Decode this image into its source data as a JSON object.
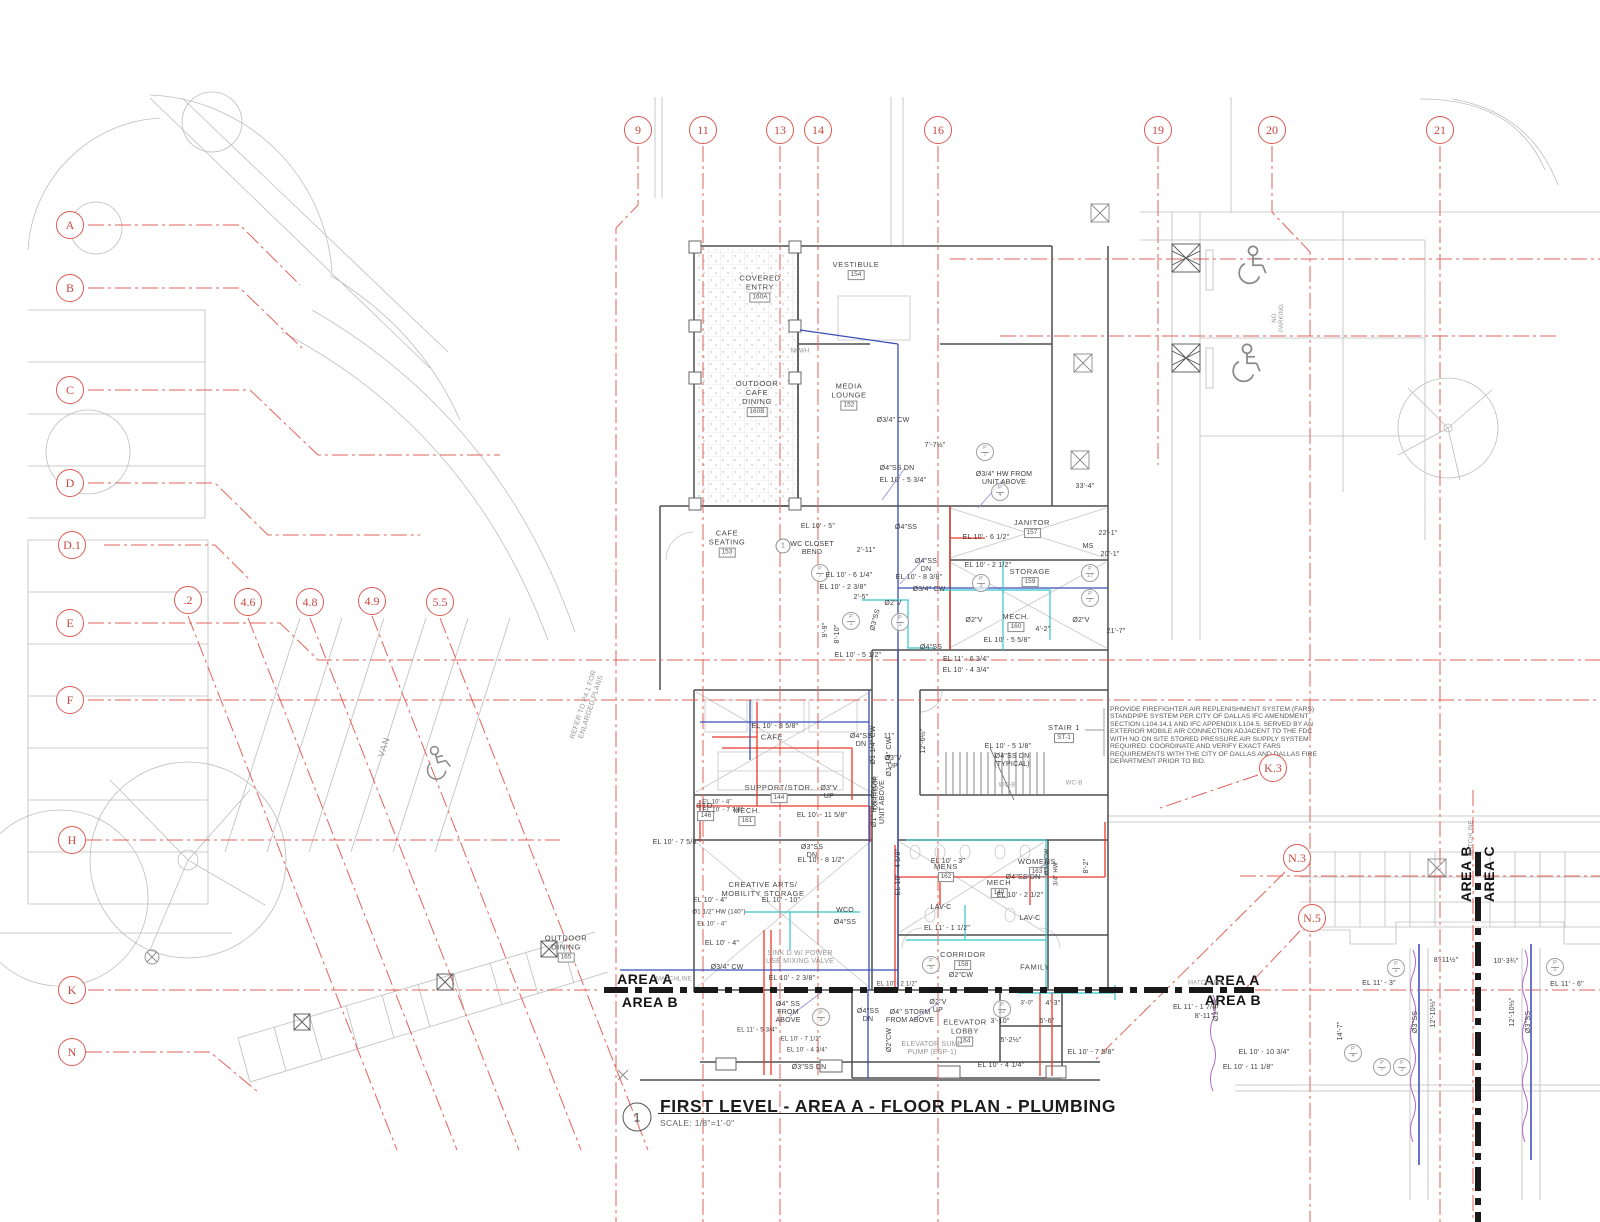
{
  "title_block": {
    "detail_number": "1",
    "title": "FIRST LEVEL - AREA A - FLOOR PLAN - PLUMBING",
    "scale": "SCALE: 1/8\"=1'-0\""
  },
  "notes": {
    "fars": "PROVIDE FIREFIGHTER AIR REPLENISHMENT SYSTEM (FARS) STANDPIPE SYSTEM PER CITY OF DALLAS IFC AMENDMENT SECTION L104.14.1 AND IFC APPENDIX L104.5. SERVED BY AN EXTERIOR MOBILE AIR CONNECTION ADJACENT TO THE FDC WITH NO ON SITE STORED PRESSURE AIR SUPPLY SYSTEM REQUIRED. COORDINATE AND VERIFY EXACT FARS REQUIREMENTS WITH THE CITY OF DALLAS AND DALLAS FIRE DEPARTMENT PRIOR TO BID."
  },
  "area_markers": {
    "left_top": "AREA A",
    "left_bottom": "AREA B",
    "right_top": "AREA A",
    "right_bottom": "AREA B",
    "vertical_left": "AREA B",
    "vertical_right": "AREA C"
  },
  "colors": {
    "grid_red": "#e2635a",
    "pipe_red": "#e8392a",
    "pipe_blue": "#3a4dbb",
    "pipe_cyan": "#33c6c9",
    "pipe_purple": "#b26bc4",
    "matchline": "#191919"
  },
  "bubbles": [
    {
      "label": "9",
      "x": 638,
      "y": 130
    },
    {
      "label": "11",
      "x": 703,
      "y": 130
    },
    {
      "label": "13",
      "x": 780,
      "y": 130
    },
    {
      "label": "14",
      "x": 818,
      "y": 130
    },
    {
      "label": "16",
      "x": 938,
      "y": 130
    },
    {
      "label": "19",
      "x": 1158,
      "y": 130
    },
    {
      "label": "20",
      "x": 1272,
      "y": 130
    },
    {
      "label": "21",
      "x": 1440,
      "y": 130
    },
    {
      "label": "A",
      "x": 70,
      "y": 225
    },
    {
      "label": "B",
      "x": 70,
      "y": 288
    },
    {
      "label": "C",
      "x": 70,
      "y": 390
    },
    {
      "label": "D",
      "x": 70,
      "y": 483
    },
    {
      "label": "D.1",
      "x": 72,
      "y": 545
    },
    {
      "label": "E",
      "x": 70,
      "y": 623
    },
    {
      "label": "F",
      "x": 70,
      "y": 700
    },
    {
      "label": "H",
      "x": 72,
      "y": 840
    },
    {
      "label": "K",
      "x": 72,
      "y": 990
    },
    {
      "label": "N",
      "x": 72,
      "y": 1052
    },
    {
      "label": ".2",
      "x": 188,
      "y": 600
    },
    {
      "label": "4.6",
      "x": 248,
      "y": 602
    },
    {
      "label": "4.8",
      "x": 310,
      "y": 602
    },
    {
      "label": "4.9",
      "x": 372,
      "y": 601
    },
    {
      "label": "5.5",
      "x": 440,
      "y": 602
    },
    {
      "label": "K.3",
      "x": 1273,
      "y": 768
    },
    {
      "label": "N.3",
      "x": 1297,
      "y": 858
    },
    {
      "label": "N.5",
      "x": 1312,
      "y": 918
    }
  ],
  "rooms": [
    {
      "label": "COVERED\nENTRY",
      "tag": "160A",
      "x": 760,
      "y": 288
    },
    {
      "label": "VESTIBULE",
      "tag": "154",
      "x": 856,
      "y": 270
    },
    {
      "label": "OUTDOOR\nCAFE\nDINING",
      "tag": "160B",
      "x": 757,
      "y": 398
    },
    {
      "label": "MEDIA\nLOUNGE",
      "tag": "152",
      "x": 849,
      "y": 396
    },
    {
      "label": "CAFE\nSEATING",
      "tag": "153",
      "x": 727,
      "y": 543
    },
    {
      "label": "JANITOR",
      "tag": "157",
      "x": 1032,
      "y": 528
    },
    {
      "label": "STORAGE",
      "tag": "159",
      "x": 1030,
      "y": 577
    },
    {
      "label": "MECH.",
      "tag": "160",
      "x": 1016,
      "y": 622
    },
    {
      "label": "STAIR 1",
      "tag": "ST-1",
      "x": 1064,
      "y": 733
    },
    {
      "label": "MENS",
      "tag": "162",
      "x": 946,
      "y": 872
    },
    {
      "label": "WOMENS",
      "tag": "163",
      "x": 1037,
      "y": 867
    },
    {
      "label": "MECH",
      "tag": "140",
      "x": 999,
      "y": 888
    },
    {
      "label": "CORRIDOR",
      "tag": "158",
      "x": 963,
      "y": 960
    },
    {
      "label": "ELEVATOR\nLOBBY",
      "tag": "164",
      "x": 965,
      "y": 1032
    },
    {
      "label": "OUTDOOR\nDINING",
      "tag": "165",
      "x": 566,
      "y": 948
    },
    {
      "label": "CREATIVE ARTS/\nMOBILITY STORAGE",
      "tag": "",
      "x": 763,
      "y": 889
    },
    {
      "label": "SUPPORT/STOR.",
      "tag": "144",
      "x": 779,
      "y": 793
    },
    {
      "label": "STO.",
      "tag": "146",
      "x": 706,
      "y": 811
    },
    {
      "label": "MECH.",
      "tag": "161",
      "x": 747,
      "y": 816
    },
    {
      "label": "CAFE",
      "tag": "",
      "x": 772,
      "y": 737
    },
    {
      "label": "FAMILY",
      "tag": "",
      "x": 1035,
      "y": 967
    }
  ],
  "p_tags": [
    {
      "t": "P",
      "n": "7",
      "x": 985,
      "y": 452
    },
    {
      "t": "P",
      "n": "4",
      "x": 1000,
      "y": 492
    },
    {
      "t": "P",
      "n": "7",
      "x": 820,
      "y": 573
    },
    {
      "t": "P",
      "n": "1",
      "x": 851,
      "y": 621
    },
    {
      "t": "P",
      "n": "1",
      "x": 900,
      "y": 622
    },
    {
      "t": "P",
      "n": "3",
      "x": 981,
      "y": 583
    },
    {
      "t": "P",
      "n": "17",
      "x": 1090,
      "y": 573
    },
    {
      "t": "P",
      "n": "2",
      "x": 1090,
      "y": 598
    },
    {
      "t": "P",
      "n": "5",
      "x": 931,
      "y": 965
    },
    {
      "t": "P",
      "n": "9",
      "x": 821,
      "y": 1017
    },
    {
      "t": "P",
      "n": "22",
      "x": 1002,
      "y": 1009
    },
    {
      "t": "P",
      "n": "2",
      "x": 1396,
      "y": 968
    },
    {
      "t": "P",
      "n": "2",
      "x": 1555,
      "y": 967
    },
    {
      "t": "P",
      "n": "4",
      "x": 1353,
      "y": 1053
    },
    {
      "t": "P",
      "n": "7",
      "x": 1382,
      "y": 1067
    },
    {
      "t": "P",
      "n": "3",
      "x": 1402,
      "y": 1067
    }
  ],
  "keynotes": [
    {
      "n": "1",
      "x": 783,
      "y": 546
    }
  ],
  "annotations": [
    {
      "t": "Ø3/4\" CW",
      "x": 893,
      "y": 421
    },
    {
      "t": "7'-7½\"",
      "x": 935,
      "y": 446
    },
    {
      "t": "Ø4\"SS DN",
      "x": 897,
      "y": 469
    },
    {
      "t": "EL 10' - 5 3/4\"",
      "x": 903,
      "y": 481
    },
    {
      "t": "Ø3/4\" HW FROM\nUNIT ABOVE",
      "x": 1004,
      "y": 479
    },
    {
      "t": "33'-4\"",
      "x": 1085,
      "y": 487
    },
    {
      "t": "NFWH",
      "x": 800,
      "y": 352,
      "c": "grey",
      "s": "xs"
    },
    {
      "t": "EL 10' - 5\"",
      "x": 818,
      "y": 527
    },
    {
      "t": "WC CLOSET\nBEND",
      "x": 812,
      "y": 549
    },
    {
      "t": "2'-11\"",
      "x": 866,
      "y": 551
    },
    {
      "t": "Ø4\"SS",
      "x": 906,
      "y": 528
    },
    {
      "t": "EL 10' - 6 1/4\"",
      "x": 849,
      "y": 576
    },
    {
      "t": "EL 10' - 2 3/8\"",
      "x": 843,
      "y": 588
    },
    {
      "t": "Ø4\"SS\nDN",
      "x": 926,
      "y": 566
    },
    {
      "t": "EL 10' - 8 3/8\"",
      "x": 919,
      "y": 578
    },
    {
      "t": "Ø3/4\" CW",
      "x": 929,
      "y": 590
    },
    {
      "t": "Ø2\"V",
      "x": 893,
      "y": 604
    },
    {
      "t": "Ø2\"V",
      "x": 974,
      "y": 621
    },
    {
      "t": "Ø2\"V",
      "x": 1081,
      "y": 621
    },
    {
      "t": "MS",
      "x": 1088,
      "y": 547
    },
    {
      "t": "EL 10' - 6 1/2\"",
      "x": 986,
      "y": 538
    },
    {
      "t": "EL 10' - 2 1/2\"",
      "x": 988,
      "y": 566
    },
    {
      "t": "22'-1\"",
      "x": 1108,
      "y": 534
    },
    {
      "t": "20'-1\"",
      "x": 1110,
      "y": 555
    },
    {
      "t": "4'-2\"",
      "x": 1043,
      "y": 630
    },
    {
      "t": "21'-7\"",
      "x": 1116,
      "y": 632
    },
    {
      "t": "EL 10' - 5 5/8\"",
      "x": 1007,
      "y": 641
    },
    {
      "t": "EL 10' - 5 1/2\"",
      "x": 858,
      "y": 656
    },
    {
      "t": "Ø4\"SS",
      "x": 931,
      "y": 648
    },
    {
      "t": "Ø3\"SS",
      "x": 876,
      "y": 620,
      "r": -75
    },
    {
      "t": "9'-9\"",
      "x": 826,
      "y": 630,
      "r": -90
    },
    {
      "t": "8'-10\"",
      "x": 838,
      "y": 634,
      "r": -90
    },
    {
      "t": "2'-5\"",
      "x": 861,
      "y": 598
    },
    {
      "t": "EL 11' - 6 3/4\"",
      "x": 966,
      "y": 660
    },
    {
      "t": "EL 10' - 4 3/4\"",
      "x": 966,
      "y": 671
    },
    {
      "t": "EL 10' - 5 1/8\"",
      "x": 1008,
      "y": 747
    },
    {
      "t": "Ø4\"SS DN\n(TYPICAL)",
      "x": 1012,
      "y": 761
    },
    {
      "t": "Ø3\"V\nUP",
      "x": 893,
      "y": 763
    },
    {
      "t": "11\"",
      "x": 889,
      "y": 737
    },
    {
      "t": "Ø1\" HW FROM\nUNIT ABOVE",
      "x": 879,
      "y": 802,
      "r": -90
    },
    {
      "t": "Ø1 1/4\" CW",
      "x": 890,
      "y": 757,
      "r": -90
    },
    {
      "t": "12'-6½\"",
      "x": 924,
      "y": 741,
      "r": -90
    },
    {
      "t": "WC-B",
      "x": 1007,
      "y": 786,
      "c": "grey",
      "s": "xs"
    },
    {
      "t": "WC-B",
      "x": 1074,
      "y": 784,
      "c": "grey",
      "s": "xs"
    },
    {
      "t": "CORRIDOR",
      "x": 877,
      "y": 793,
      "r": -90,
      "s": "xs"
    },
    {
      "t": "EL 10' - 3\"",
      "x": 948,
      "y": 862
    },
    {
      "t": "Ø4\"SS DN",
      "x": 1023,
      "y": 878
    },
    {
      "t": "EL 10' - 2 1/2\"",
      "x": 1020,
      "y": 896
    },
    {
      "t": "LAV-C",
      "x": 941,
      "y": 908
    },
    {
      "t": "LAV-C",
      "x": 1030,
      "y": 919
    },
    {
      "t": "EL 11' - 1 1/2\"",
      "x": 947,
      "y": 929
    },
    {
      "t": "EL 10' - 4 5/8\"",
      "x": 899,
      "y": 872,
      "r": -90
    },
    {
      "t": "8'-2\"",
      "x": 1087,
      "y": 866,
      "r": -90
    },
    {
      "t": "Ø3/4\"CW",
      "x": 1048,
      "y": 862,
      "r": -90,
      "s": "xs"
    },
    {
      "t": "3/4\" HW",
      "x": 1057,
      "y": 874,
      "r": -90,
      "s": "xs"
    },
    {
      "t": "Ø2\"CW",
      "x": 961,
      "y": 976
    },
    {
      "t": "EL 10' - 8 5/8\"",
      "x": 775,
      "y": 727
    },
    {
      "t": "Ø4\"SS\nDN",
      "x": 861,
      "y": 741
    },
    {
      "t": "Ø1 1/4\" CW",
      "x": 874,
      "y": 745,
      "r": -90
    },
    {
      "t": "Ø3\"V\nUP",
      "x": 829,
      "y": 793
    },
    {
      "t": "EL 10' - 11 5/8\"",
      "x": 822,
      "y": 816
    },
    {
      "t": "EL 10' - 4\"",
      "x": 717,
      "y": 803,
      "s": "xs"
    },
    {
      "t": "EL 10' - 7 7/8\"",
      "x": 723,
      "y": 811,
      "s": "xs"
    },
    {
      "t": "Ø3\"SS\nDN",
      "x": 812,
      "y": 852
    },
    {
      "t": "EL 10' - 8 1/2\"",
      "x": 821,
      "y": 861
    },
    {
      "t": "EL 10' - 7 5/8\"",
      "x": 676,
      "y": 843
    },
    {
      "t": "EL 10' - 4\"",
      "x": 710,
      "y": 901
    },
    {
      "t": "Ø1 1/2\" HW (140°)",
      "x": 719,
      "y": 913,
      "s": "xs"
    },
    {
      "t": "EL 10' - 4\"",
      "x": 712,
      "y": 925,
      "s": "xs"
    },
    {
      "t": "EL 10' - 10\"",
      "x": 781,
      "y": 901
    },
    {
      "t": "WCO",
      "x": 845,
      "y": 911
    },
    {
      "t": "Ø4\"SS",
      "x": 845,
      "y": 923
    },
    {
      "t": "SINK D W/ POWER\nUSE MIXING VALVE",
      "x": 800,
      "y": 958,
      "c": "grey"
    },
    {
      "t": "EL 10' - 4\"",
      "x": 722,
      "y": 944
    },
    {
      "t": "Ø3/4\" CW",
      "x": 727,
      "y": 968
    },
    {
      "t": "EL 10' - 2 3/8\"",
      "x": 792,
      "y": 979
    },
    {
      "t": "Ø4\" SS\nFROM\nABOVE",
      "x": 788,
      "y": 1013
    },
    {
      "t": "MATCHLINE",
      "x": 674,
      "y": 980,
      "c": "grey",
      "s": "xs"
    },
    {
      "t": "MATCHLINE",
      "x": 1206,
      "y": 984,
      "c": "grey",
      "s": "xs"
    },
    {
      "t": "MATCHLINE",
      "x": 1472,
      "y": 838,
      "r": -90,
      "c": "grey",
      "s": "xs"
    },
    {
      "t": "Ø4\" STORM\nFROM ABOVE",
      "x": 910,
      "y": 1017
    },
    {
      "t": "Ø2\"V\nUP",
      "x": 938,
      "y": 1007
    },
    {
      "t": "Ø4\"SS\nDN",
      "x": 868,
      "y": 1016
    },
    {
      "t": "Ø2\"CW",
      "x": 890,
      "y": 1040,
      "r": -90
    },
    {
      "t": "EL 10' - 2 1/2\"",
      "x": 897,
      "y": 985,
      "s": "xs"
    },
    {
      "t": "ELEVATOR SUMP\nPUMP (ESP-1)",
      "x": 932,
      "y": 1049,
      "c": "grey"
    },
    {
      "t": "3'-10\"",
      "x": 1000,
      "y": 1022
    },
    {
      "t": "5'-2½\"",
      "x": 1011,
      "y": 1041
    },
    {
      "t": "3'-0\"",
      "x": 1027,
      "y": 1004,
      "s": "xs"
    },
    {
      "t": "4'-3\"",
      "x": 1053,
      "y": 1004
    },
    {
      "t": "6'-6\"",
      "x": 1047,
      "y": 1022
    },
    {
      "t": "EL 10' - 4 1/4\"",
      "x": 1001,
      "y": 1066
    },
    {
      "t": "EL 10' - 7 1/2\"",
      "x": 801,
      "y": 1040,
      "s": "xs"
    },
    {
      "t": "EL 10' - 4 3/4\"",
      "x": 807,
      "y": 1051,
      "s": "xs"
    },
    {
      "t": "EL 11' - 5 3/4\"",
      "x": 757,
      "y": 1031,
      "s": "xs"
    },
    {
      "t": "Ø3\"SS DN",
      "x": 809,
      "y": 1068
    },
    {
      "t": "REFER TO P4.1 FOR\nENLARGED PLANS",
      "x": 588,
      "y": 706,
      "r": -72,
      "c": "grey"
    },
    {
      "t": "VAN",
      "x": 384,
      "y": 747,
      "r": -72,
      "c": "grey",
      "s": "md"
    },
    {
      "t": "NO\nPARKING",
      "x": 1279,
      "y": 318,
      "r": -90,
      "c": "grey",
      "s": "xs"
    },
    {
      "t": "8'-11½\"",
      "x": 1446,
      "y": 961
    },
    {
      "t": "10'-3¾\"",
      "x": 1506,
      "y": 962
    },
    {
      "t": "EL 11' - 3\"",
      "x": 1379,
      "y": 984
    },
    {
      "t": "EL 11' - 6\"",
      "x": 1567,
      "y": 985
    },
    {
      "t": "Ø3\"SS",
      "x": 1416,
      "y": 1022,
      "r": -90
    },
    {
      "t": "Ø3\"SS",
      "x": 1529,
      "y": 1022,
      "r": -90
    },
    {
      "t": "12'-10½\"",
      "x": 1434,
      "y": 1013,
      "r": -90
    },
    {
      "t": "12'-10½\"",
      "x": 1513,
      "y": 1012,
      "r": -90
    },
    {
      "t": "14'-7\"",
      "x": 1341,
      "y": 1031,
      "r": -90
    },
    {
      "t": "EL 10' - 10 3/4\"",
      "x": 1264,
      "y": 1053
    },
    {
      "t": "EL 10' - 11 1/8\"",
      "x": 1248,
      "y": 1068
    },
    {
      "t": "EL 10' - 7 5/8\"",
      "x": 1091,
      "y": 1053
    },
    {
      "t": "EL 11' - 1 7/8\"",
      "x": 1196,
      "y": 1008
    },
    {
      "t": "8'-11\"",
      "x": 1204,
      "y": 1017
    },
    {
      "t": "Ø3\"SS",
      "x": 1217,
      "y": 1010,
      "r": -90
    }
  ]
}
